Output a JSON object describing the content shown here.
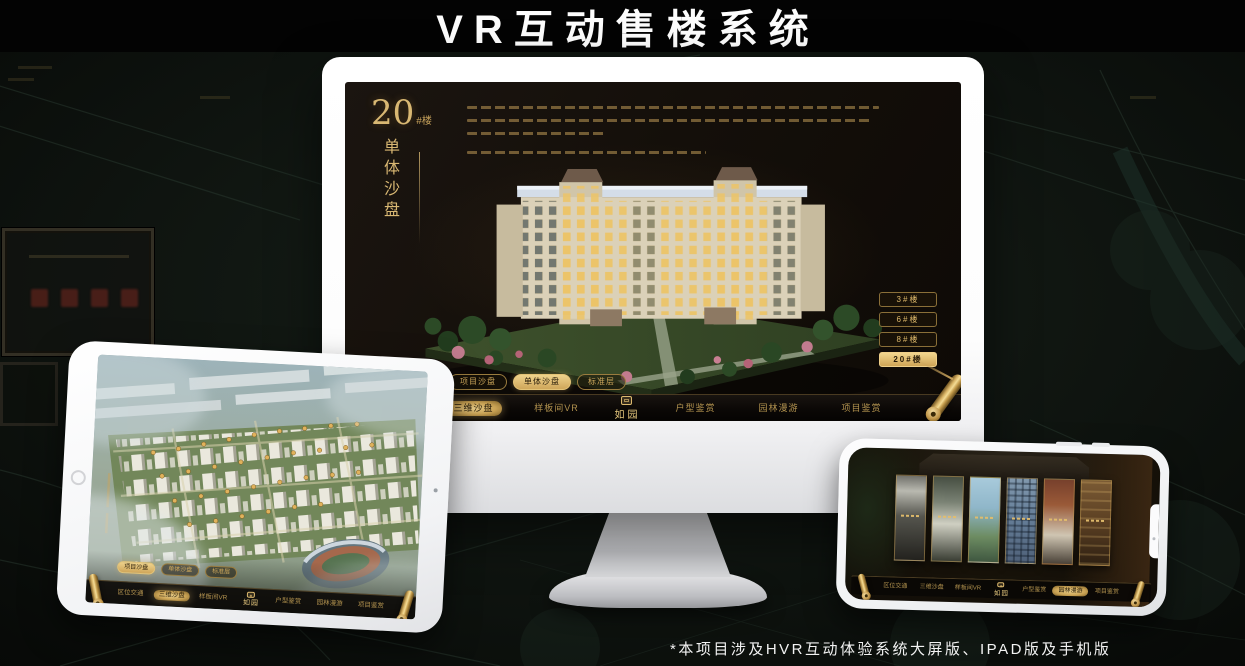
{
  "page": {
    "title": "VR互动售楼系统",
    "footnote": "*本项目涉及HVR互动体验系统大屏版、IPAD版及手机版"
  },
  "colors": {
    "gold": "#c9a45c",
    "gold_bright": "#e6c87e",
    "monitor_screen_bg": "#16110b",
    "nav_bg": "#0a0806",
    "active_tab_text": "#2a1d08"
  },
  "logo": {
    "name": "如园"
  },
  "nav": {
    "items": [
      "区位交通",
      "三维沙盘",
      "样板间VR",
      "户型鉴赏",
      "园林漫游",
      "项目鉴赏"
    ]
  },
  "monitor": {
    "title_num": "20",
    "title_suffix": "#楼",
    "subtitle": "单体沙盘",
    "floor_buttons": [
      {
        "label": "3#楼"
      },
      {
        "label": "6#楼"
      },
      {
        "label": "8#楼"
      },
      {
        "label": "20#楼"
      }
    ],
    "active_floor": "20#楼",
    "sub_tabs": [
      {
        "label": "项目沙盘"
      },
      {
        "label": "单体沙盘"
      },
      {
        "label": "标准层"
      }
    ],
    "active_sub_tab": "单体沙盘",
    "active_nav_item": "三维沙盘"
  },
  "ipad": {
    "active_sub_tab": "项目沙盘",
    "active_nav_item": "三维沙盘"
  },
  "phone": {
    "active_nav_item": "园林漫游",
    "gallery_panel_count": 6
  }
}
